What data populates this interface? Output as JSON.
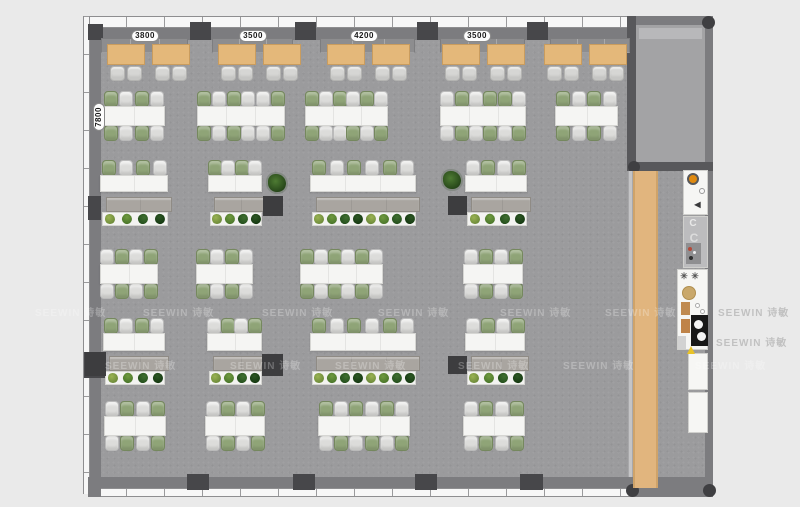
{
  "page": {
    "background": "#eaeaea"
  },
  "dimensions": {
    "top_labels": [
      "3800",
      "3500",
      "4200",
      "3500"
    ],
    "left_label": "7800",
    "top_positions_x": [
      145,
      253,
      364,
      477
    ],
    "top_y": 30,
    "left_position": {
      "x": 99,
      "y": 117
    }
  },
  "watermark": {
    "text": "SEEWIN 诗敏",
    "rows": [
      {
        "y": 304,
        "xs": [
          35,
          143,
          262,
          378,
          500,
          605,
          718
        ]
      },
      {
        "y": 357,
        "xs": [
          105,
          230,
          335,
          458,
          563,
          695
        ]
      }
    ],
    "margin_extra": [
      {
        "x": 716,
        "y": 334
      }
    ]
  },
  "colors": {
    "floor": "#9b9b9d",
    "wall": "#7c7c7f",
    "column": "#47474a",
    "desk": "#f5f5f3",
    "chair_green": "#8fa477",
    "chair_gray": "#dcdcda",
    "lounge_table": "#e4b87a",
    "bench": "#8d8d8f",
    "cabinet": "#a9a5a0",
    "planter": "#f3f3f1",
    "dark_box": "#3d3d3f",
    "walkway": "#e1b57e",
    "counter": "#f6f6f4",
    "knob_orange": "#e08a10",
    "plate_gold": "#c9a86b",
    "machine_black": "#181818",
    "warning_yellow": "#e8c227"
  },
  "layout": {
    "floor": [
      101,
      40,
      604,
      437
    ],
    "walls": [
      {
        "n": "window-band-top",
        "t": "winH",
        "r": [
          88,
          16,
          539,
          12
        ]
      },
      {
        "n": "top-wall-right",
        "t": "wall",
        "r": [
          627,
          16,
          86,
          12
        ]
      },
      {
        "n": "top-wall",
        "t": "wall",
        "r": [
          88,
          28,
          622,
          12
        ]
      },
      {
        "n": "window-band-left",
        "t": "winV",
        "r": [
          83,
          16,
          7,
          478
        ]
      },
      {
        "n": "left-wall",
        "t": "wall",
        "r": [
          90,
          28,
          11,
          450
        ]
      },
      {
        "n": "right-wall",
        "t": "wall",
        "r": [
          705,
          16,
          8,
          481
        ]
      },
      {
        "n": "bottom-wall",
        "t": "wall",
        "r": [
          101,
          477,
          604,
          11
        ]
      },
      {
        "n": "window-band-bottom",
        "t": "winH",
        "r": [
          88,
          488,
          542,
          9
        ]
      },
      {
        "n": "bottom-wall-right",
        "t": "wall",
        "r": [
          630,
          488,
          80,
          9
        ]
      },
      {
        "n": "corner-bottom-left",
        "t": "wall",
        "r": [
          88,
          477,
          13,
          20
        ]
      }
    ],
    "columns": [
      [
        88,
        24,
        15,
        16
      ],
      [
        190,
        22,
        21,
        18
      ],
      [
        295,
        22,
        21,
        18
      ],
      [
        417,
        22,
        21,
        18
      ],
      [
        527,
        22,
        21,
        18
      ],
      [
        187,
        474,
        22,
        16
      ],
      [
        293,
        474,
        22,
        16
      ],
      [
        415,
        474,
        22,
        16
      ],
      [
        520,
        474,
        23,
        16
      ],
      [
        88,
        196,
        13,
        24
      ],
      [
        84,
        352,
        21,
        26
      ]
    ],
    "round_columns": [
      [
        702,
        16,
        13
      ],
      [
        626,
        484,
        13
      ],
      [
        703,
        484,
        13
      ],
      [
        628,
        161,
        12
      ]
    ],
    "room": {
      "left_wall": [
        627,
        16,
        9,
        155
      ],
      "bottom_wall": [
        627,
        162,
        86,
        9
      ],
      "floor": [
        636,
        25,
        69,
        137
      ],
      "credenza": [
        638,
        27,
        65,
        13
      ]
    },
    "lounge": {
      "benches": [
        [
          101,
          38,
          87
        ],
        [
          212,
          38,
          81
        ],
        [
          320,
          38,
          95
        ],
        [
          440,
          38,
          85
        ],
        [
          550,
          38,
          80
        ]
      ],
      "tables_x": [
        107,
        152,
        218,
        263,
        327,
        372,
        442,
        487,
        544,
        589
      ],
      "table_y": 44,
      "table_w": 38,
      "table_h": 21,
      "chair_y": 66
    },
    "bench_rows": [
      {
        "table_y": 106,
        "table_h": 20,
        "blocks": [
          {
            "x": 103,
            "w": 62,
            "seats": 4,
            "top": "gwgw",
            "bot": "gwgw"
          },
          {
            "x": 197,
            "w": 88,
            "seats": 6,
            "top": "gwgwwg",
            "bot": "gwgwwg"
          },
          {
            "x": 305,
            "w": 83,
            "seats": 6,
            "top": "gwgwgw",
            "bot": "gwwgwg"
          },
          {
            "x": 440,
            "w": 86,
            "seats": 6,
            "top": "wgwggw",
            "bot": "wgwgwg"
          },
          {
            "x": 555,
            "w": 63,
            "seats": 4,
            "top": "gwgw",
            "bot": "gwgw"
          }
        ]
      },
      {
        "table_y": 264,
        "table_h": 20,
        "blocks": [
          {
            "x": 100,
            "w": 58,
            "seats": 4,
            "top": "wgwg",
            "bot": "wgwg"
          },
          {
            "x": 196,
            "w": 57,
            "seats": 4,
            "top": "gwgw",
            "bot": "gwgw"
          },
          {
            "x": 300,
            "w": 83,
            "seats": 6,
            "top": "gwgwgw",
            "bot": "gwgwgw"
          },
          {
            "x": 463,
            "w": 60,
            "seats": 4,
            "top": "wgwg",
            "bot": "wgwg"
          }
        ]
      },
      {
        "table_y": 416,
        "table_h": 20,
        "blocks": [
          {
            "x": 104,
            "w": 62,
            "seats": 4,
            "top": "wgwg",
            "bot": "wgwg"
          },
          {
            "x": 205,
            "w": 60,
            "seats": 4,
            "top": "wgwg",
            "bot": "wgwg"
          },
          {
            "x": 318,
            "w": 92,
            "seats": 6,
            "top": "gwgwgw",
            "bot": "wgwgwg"
          },
          {
            "x": 463,
            "w": 62,
            "seats": 4,
            "top": "wgwg",
            "bot": "wgwg"
          }
        ]
      }
    ],
    "storage_rows": [
      {
        "chair_y": 160,
        "table_y": 175,
        "table_h": 17,
        "cab_y": 197,
        "plant_y": 212,
        "blocks": [
          {
            "x": 100,
            "w": 68,
            "seats": 4,
            "top": "gwgw",
            "plants": 4
          },
          {
            "x": 208,
            "w": 54,
            "seats": 4,
            "top": "gwgw",
            "plants": 4
          },
          {
            "x": 310,
            "w": 106,
            "seats": 6,
            "top": "gwgwgw",
            "plants": 8
          },
          {
            "x": 465,
            "w": 62,
            "seats": 4,
            "top": "wgwg",
            "plants": 4
          }
        ]
      },
      {
        "chair_y": 318,
        "table_y": 333,
        "table_h": 18,
        "cab_y": 356,
        "plant_y": 371,
        "blocks": [
          {
            "x": 103,
            "w": 62,
            "seats": 4,
            "top": "gwgw",
            "plants": 4
          },
          {
            "x": 207,
            "w": 55,
            "seats": 4,
            "top": "wgwg",
            "plants": 4
          },
          {
            "x": 310,
            "w": 106,
            "seats": 6,
            "top": "gwgwgw",
            "plants": 8
          },
          {
            "x": 465,
            "w": 60,
            "seats": 4,
            "top": "wgwg",
            "plants": 4
          }
        ]
      }
    ],
    "dark_boxes": [
      [
        263,
        196,
        20,
        20
      ],
      [
        448,
        196,
        19,
        19
      ],
      [
        85,
        352,
        21,
        24
      ],
      [
        262,
        354,
        21,
        22
      ],
      [
        448,
        356,
        19,
        18
      ]
    ],
    "potted_plants": [
      [
        268,
        174
      ],
      [
        443,
        171
      ]
    ],
    "walkway": {
      "glass": [
        628,
        171,
        5,
        306
      ],
      "strip": [
        633,
        171,
        25,
        317
      ]
    },
    "kitchen": {
      "boxes": [
        {
          "n": "coffee-station",
          "r": [
            683,
            170,
            25,
            45
          ]
        },
        {
          "n": "sink-unit",
          "r": [
            683,
            216,
            25,
            52
          ],
          "c": "#bcbcbe"
        },
        {
          "n": "kitchen-counter",
          "r": [
            677,
            269,
            31,
            81
          ]
        },
        {
          "n": "kitchen-counter",
          "r": [
            688,
            353,
            20,
            37
          ]
        },
        {
          "n": "kitchen-counter",
          "r": [
            688,
            392,
            20,
            41
          ]
        }
      ],
      "details": [
        {
          "t": "circle",
          "n": "knob-orange",
          "r": [
            687,
            173,
            12,
            12
          ],
          "c": "#e08a10",
          "bd": "2px solid #58595b"
        },
        {
          "t": "circle",
          "n": "dial",
          "r": [
            699,
            188,
            6,
            6
          ],
          "c": "#f8f8f8",
          "bd": "1px solid #999999"
        },
        {
          "t": "glyph",
          "n": "speaker-icon",
          "r": [
            692,
            200,
            11,
            10
          ],
          "g": "◀",
          "c": "#3a3a3c",
          "fs": 8
        },
        {
          "t": "glyph",
          "n": "faucet-handle",
          "r": [
            687,
            218,
            12,
            11
          ],
          "g": "C",
          "c": "#e8e8e8",
          "fs": 10
        },
        {
          "t": "glyph",
          "n": "faucet-handle",
          "r": [
            687,
            231,
            14,
            14
          ],
          "g": "C",
          "c": "#dcdcdc",
          "fs": 12
        },
        {
          "t": "rect",
          "n": "hob",
          "r": [
            686,
            243,
            15,
            21
          ],
          "c": "#8f8f91"
        },
        {
          "t": "circle",
          "n": "hob-dot",
          "r": [
            688,
            247,
            4,
            4
          ],
          "c": "#b44a3a"
        },
        {
          "t": "circle",
          "n": "hob-dot",
          "r": [
            693,
            251,
            3,
            3
          ],
          "c": "#f0f0f0"
        },
        {
          "t": "circle",
          "n": "hob-dot",
          "r": [
            689,
            256,
            4,
            4
          ],
          "c": "#2f2f2f"
        },
        {
          "t": "glyph",
          "n": "fan-icon",
          "r": [
            679,
            271,
            10,
            10
          ],
          "g": "✳",
          "c": "#555555",
          "fs": 9
        },
        {
          "t": "glyph",
          "n": "fan-icon",
          "r": [
            690,
            271,
            10,
            10
          ],
          "g": "✳",
          "c": "#555555",
          "fs": 9
        },
        {
          "t": "circle",
          "n": "plate-gold",
          "r": [
            682,
            286,
            14,
            14
          ],
          "c": "#c9a86b",
          "bd": "1px solid #b08f4f"
        },
        {
          "t": "rect",
          "n": "jar",
          "r": [
            681,
            302,
            9,
            13
          ],
          "c": "#c08a50"
        },
        {
          "t": "rect",
          "n": "jar",
          "r": [
            681,
            319,
            9,
            14
          ],
          "c": "#bf8348"
        },
        {
          "t": "circle",
          "n": "cup",
          "r": [
            695,
            303,
            5,
            5
          ],
          "c": "#ffffff",
          "bd": "1px solid #aaaaaa"
        },
        {
          "t": "circle",
          "n": "cup",
          "r": [
            700,
            309,
            5,
            5
          ],
          "c": "#ffffff",
          "bd": "1px solid #aaaaaa"
        },
        {
          "t": "rect",
          "n": "espresso-machine",
          "r": [
            691,
            315,
            17,
            31
          ],
          "c": "#181818"
        },
        {
          "t": "circle",
          "n": "machine-dial",
          "r": [
            694,
            320,
            9,
            9
          ],
          "c": "#f4f4f4"
        },
        {
          "t": "circle",
          "n": "machine-dial",
          "r": [
            697,
            332,
            9,
            9
          ],
          "c": "#f4f4f4"
        },
        {
          "t": "rect",
          "n": "tray",
          "r": [
            678,
            336,
            8,
            13
          ],
          "c": "#d2d2d2"
        },
        {
          "t": "tri",
          "n": "warning-icon",
          "r": [
            687,
            346,
            9,
            8
          ],
          "c": "#e8c227"
        }
      ]
    }
  }
}
